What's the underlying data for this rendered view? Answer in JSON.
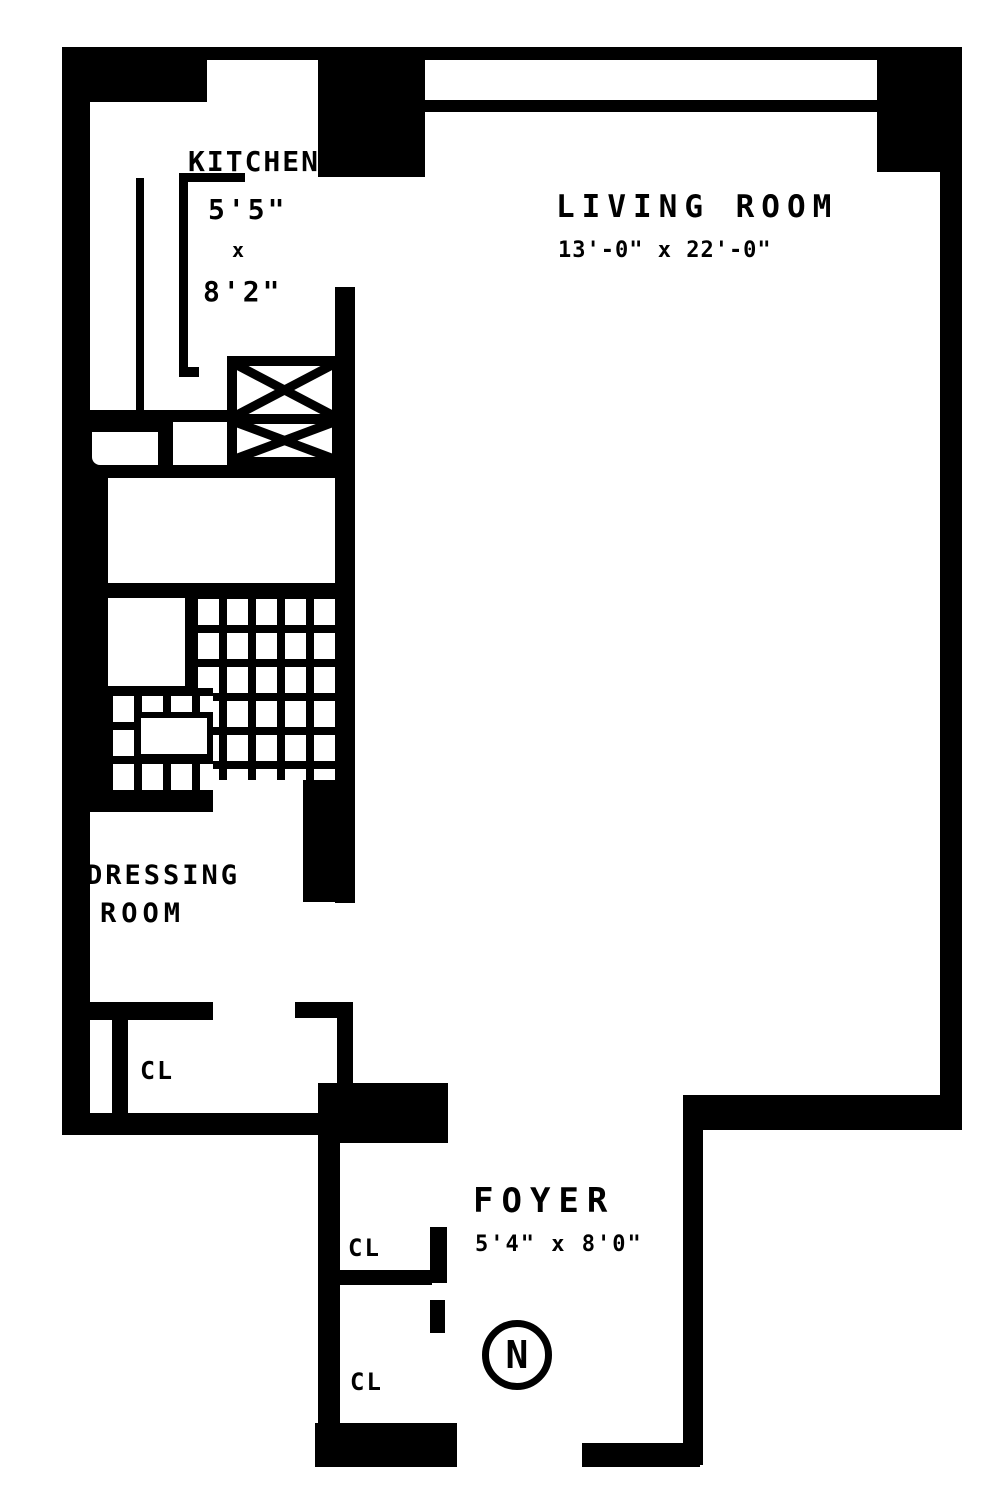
{
  "rooms": {
    "kitchen": {
      "name": "KITCHEN",
      "dim1": "5'5\"",
      "dim_sep": "x",
      "dim2": "8'2\""
    },
    "living_room": {
      "name": "LIVING ROOM",
      "dims": "13'-0\" x 22'-0\""
    },
    "dressing_room": {
      "name_line1": "DRESSING",
      "name_line2": "ROOM"
    },
    "foyer": {
      "name": "FOYER",
      "dims": "5'4\" x 8'0\""
    }
  },
  "closets": {
    "dressing_closet": "CL",
    "foyer_closet_upper": "CL",
    "foyer_closet_lower": "CL"
  },
  "compass": {
    "north": "N"
  },
  "colors": {
    "wall": "#000000",
    "floor": "#ffffff"
  }
}
